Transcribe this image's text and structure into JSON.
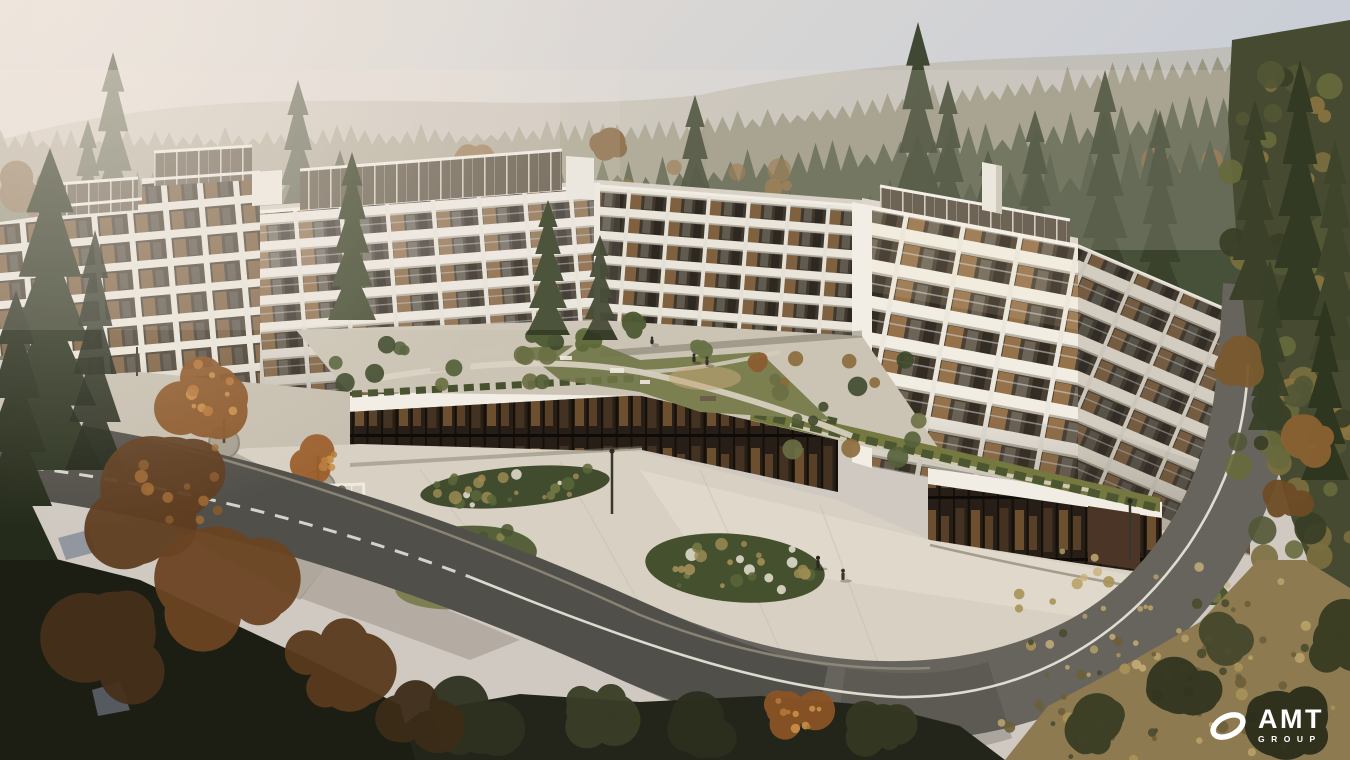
{
  "scene": {
    "alt": "Aerial architectural rendering of a large curved white residential complex with balconies, a landscaped podium courtyard and plaza, wrapped by a curving asphalt road in an autumn conifer forest under hazy morning light",
    "setting": "forested hillside, autumn, hazy sunlight from upper left",
    "elements": [
      "white apartment complex",
      "glass penthouses",
      "ground-floor glazing",
      "podium courtyard garden",
      "paved plaza with planting beds",
      "curved ring road with white line",
      "conifer forest",
      "rust-colored autumn trees",
      "pedestrians"
    ]
  },
  "logo": {
    "brand": "AMT",
    "subtext": "GROUP",
    "icon": "ellipse-ring-icon",
    "color": "#ffffff"
  },
  "palette": {
    "sky1": "#e6dedа-FIX",
    "sky2": "#c7cdd7",
    "hazeTint": "#f0e7dc",
    "forestFar": "#a39e8a",
    "forestMid": "#6c7158",
    "forestNear": "#47513a",
    "forestDark": "#3a4129",
    "facade": "#ece7de",
    "facadeLit": "#f4efe6",
    "facadeShade": "#d8d2c6",
    "glassDark": "#453c30",
    "glassWarm": "#9a734a",
    "paving": "#d7d0c3",
    "pavingShade": "#b5aea1",
    "road": "#67645e",
    "roadDark": "#4a4742",
    "roadLine": "#eceadf",
    "garden": "#76793f",
    "lawn": "#7c7f4f",
    "shrub": "#4c5630",
    "autumn": "#8a5a2c",
    "autumnLit": "#b97f3f",
    "brush": "#9a8456",
    "groundDark": "#20221a",
    "logo": "#ffffff"
  }
}
